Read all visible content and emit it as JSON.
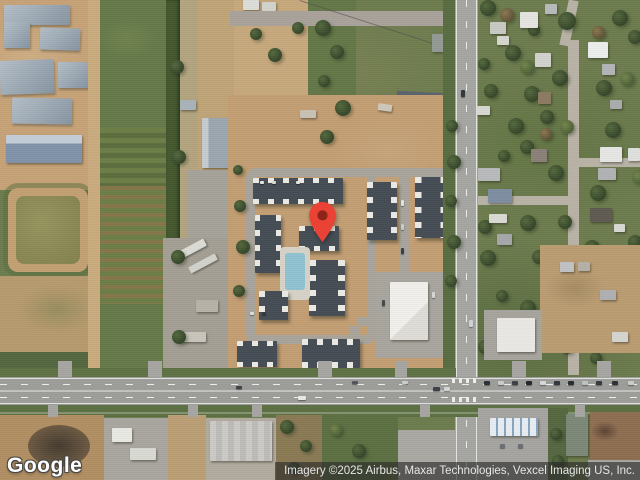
{
  "branding": {
    "logo_text": "Google"
  },
  "attribution": {
    "text": "Imagery ©2025 Airbus, Maxar Technologies, Vexcel Imaging US, Inc."
  },
  "marker": {
    "label": "location-pin",
    "color": "#EA4335",
    "inner_color": "#8E2317",
    "tip_x": 322,
    "tip_y": 241
  }
}
